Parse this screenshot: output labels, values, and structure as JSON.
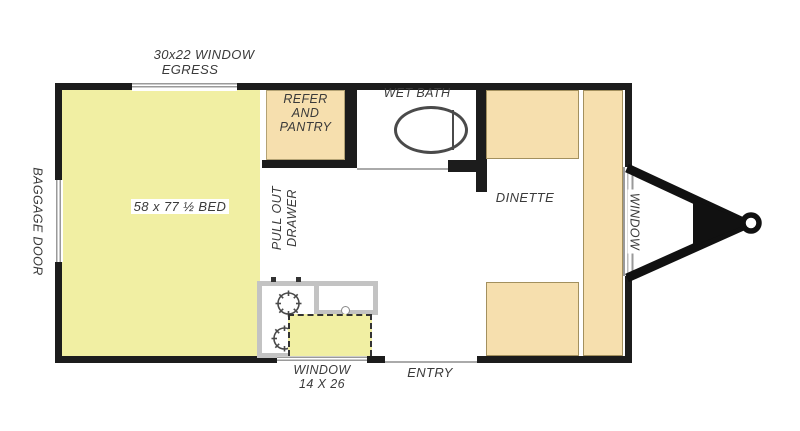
{
  "figure": {
    "type": "travel-trailer floor plan"
  },
  "colors": {
    "bed_fill": "#f1efa3",
    "cabinet_fill": "#f6dfae",
    "wall": "#1c1c1c",
    "fixture_gray": "#c3c3c3",
    "window_gray": "#9a9a9a",
    "label_text": "#3a3a3a"
  },
  "labels": {
    "egress_window": {
      "line1": "30x22 WINDOW",
      "line2": "EGRESS"
    },
    "baggage_door": "BAGGAGE DOOR",
    "bed": "58 x 77 ½ BED",
    "refer_pantry": {
      "line1": "REFER",
      "line2": "AND",
      "line3": "PANTRY"
    },
    "wet_bath": "WET BATH",
    "dinette": "DINETTE",
    "side_window": "WINDOW",
    "pull_out_drawer": {
      "line1": "PULL OUT",
      "line2": "DRAWER"
    },
    "galley_window": {
      "line1": "WINDOW",
      "line2": "14 X 26"
    },
    "entry": "ENTRY"
  }
}
